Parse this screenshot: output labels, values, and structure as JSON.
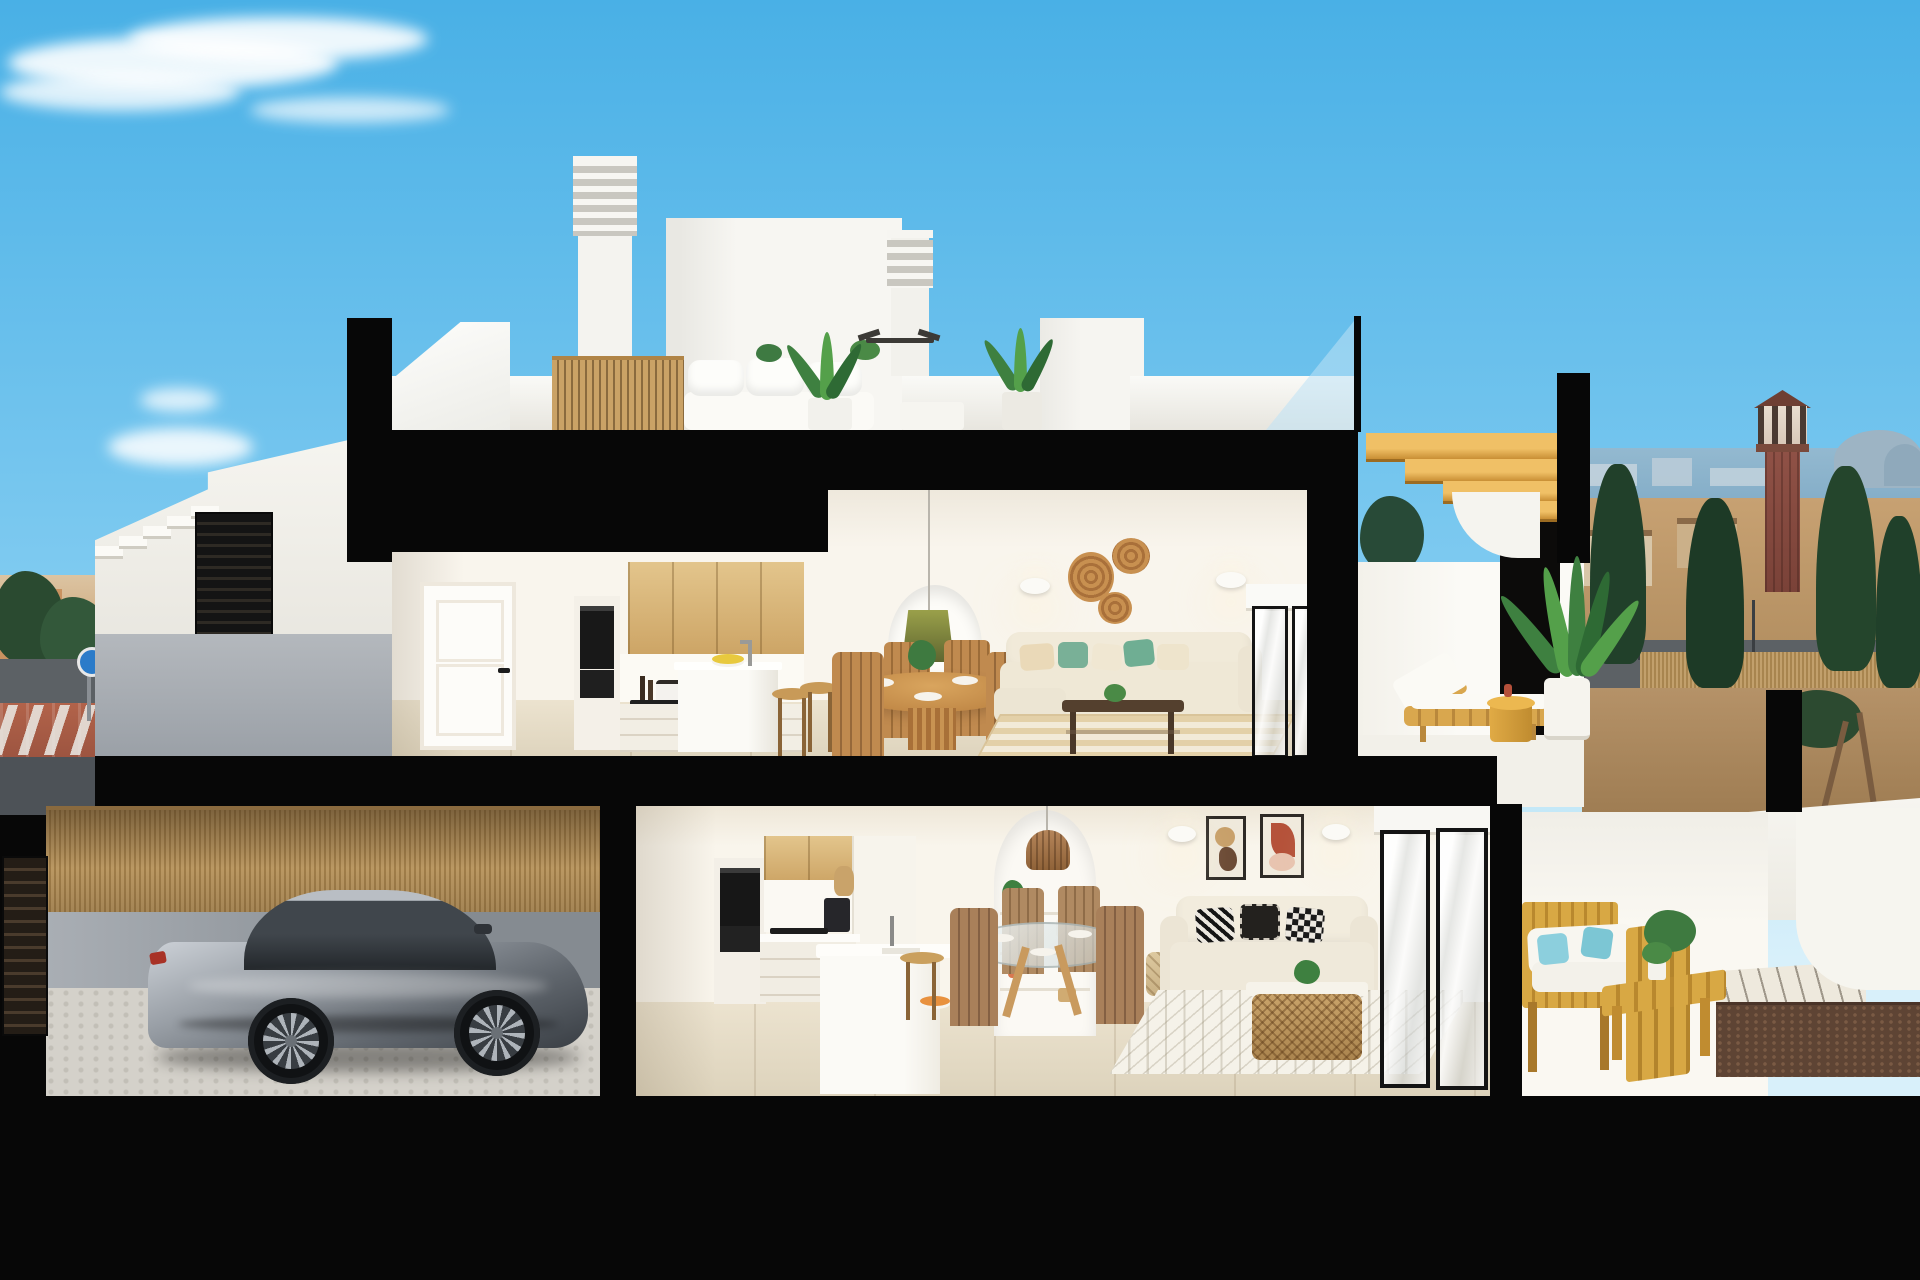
{
  "meta": {
    "title": "Cross-section architectural render",
    "description": "Photorealistic cutaway render of a two-storey coastal townhouse: rooftop terrace with chimneys and lounge, upper floor with oak kitchen, dining set, arched niche living room and sun terrace with timber lounger, ground floor with garage housing a silver sports coupe, second kitchen, glass dining table, loveseat living room and acacia-furnished terrace, all framed by thick black section cuts under a blue sky with a seaside town, lookout tower and trees in the background."
  },
  "palette": {
    "sky_top": "#49b0e6",
    "sky_mid": "#7ecaf0",
    "sky_low": "#c2e7f7",
    "cut_black": "#070707",
    "wall_white": "#f6f5f1",
    "wall_shade": "#e9e6df",
    "wood_cabinet": "#d9b87e",
    "wood_stair": "#dfa94e",
    "floor_tile": "#e6ddc8",
    "sea": "#85aec8",
    "field_tan": "#c5a173",
    "tree_dark": "#23422b",
    "road_gray": "#5c6165",
    "sidewalk_red": "#a65a42",
    "car_silver": "#9aa0a7",
    "amber_wood": "#cf9b3c",
    "pillow_green": "#79b097",
    "pillow_blue": "#8ccfdd",
    "rattan": "#b9824f",
    "pendant_olive": "#7c8138",
    "terracotta": "#d97850",
    "tower_brick": "#8f5146"
  },
  "scene": {
    "environment": {
      "sky": "clear blue sky",
      "clouds": [
        "large wispy cloud top-left",
        "two small clouds mid-left"
      ],
      "left_background": "low-rise tan town, dark trees, street with red-brown sidewalk, crosswalk and blue round sign",
      "right_background": {
        "sea": "sea horizon with distant skyline and hills",
        "tower": "brick lookout tower with cupola",
        "vegetation": "dark cypress and palm trees",
        "street": "road with lampposts and reed-cane fence"
      }
    },
    "building": {
      "type": "two-storey townhouse cross-section with basement garage",
      "roof_terrace": [
        "two louvered chimneys",
        "stair bulkhead",
        "white outdoor sofa",
        "timber slat screen",
        "potted palms",
        "ceiling fan",
        "glass balustrade",
        "timber roof stair"
      ],
      "upper_floor": {
        "rooms": [
          "hallway with white panel door",
          "kitchen: oak uppers, black oven column, white island, two oak stools, lemon bowl",
          "dining: round oak table, four timber chairs, plates",
          "living: arched shelf niche with olive pendant, orange vases and plants, two sconces, three rattan wall plates, cream sofa with green cushions, dark wood coffee table, striped jute rug",
          "sliding glass door"
        ],
        "terrace": [
          "timber sun lounger with white cushion",
          "amber drum side table",
          "potted areca palm",
          "curved white parapet"
        ]
      },
      "ground_floor": {
        "rooms": [
          "garage: silver sports coupe, cobblestone floor, reed-cane fence, dark slatted door",
          "kitchen: oak uppers, oven column, coffee machine, white peninsula with sink, oak stool",
          "dining: round glass table, four timber chairs",
          "living: arched niche with rattan pendant, two abstract prints, two sconces, cream loveseat with patterned pillows, rattan coffee table, diamond rug, hanging basket",
          "sliding glass doors"
        ],
        "terrace": [
          "acacia sofa with white cushions and aqua pillows",
          "acacia bench table",
          "white diagonal-paved band",
          "gravel planter strip",
          "white ramp and curved wall"
        ]
      },
      "entrance": "external white staircase over grey street wall with dark slatted gate"
    }
  }
}
